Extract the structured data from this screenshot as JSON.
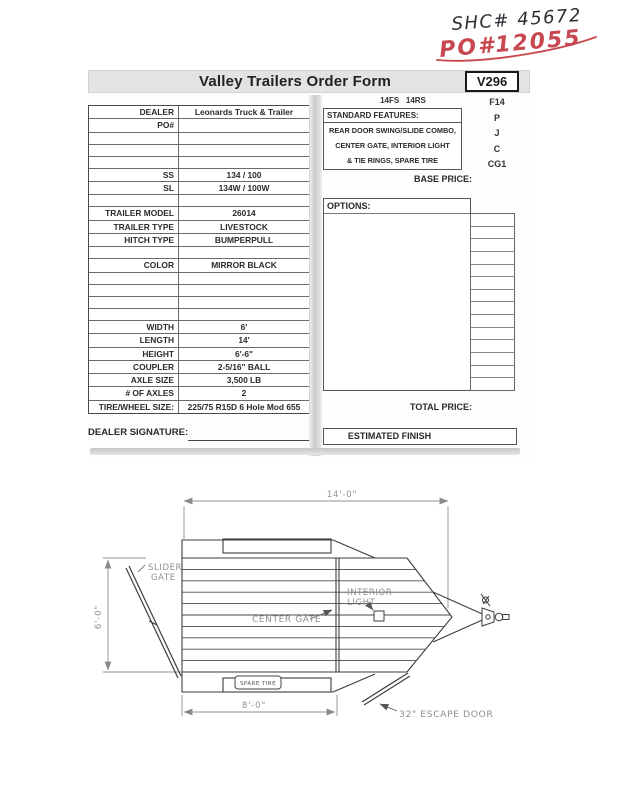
{
  "handwriting": {
    "line1": "SHC# 45672",
    "line2": "PO#12055"
  },
  "header": {
    "title": "Valley Trailers Order Form",
    "form_code": "V296",
    "model_codes": "14FS   14RS"
  },
  "feature_codes": [
    "F14",
    "P",
    "J",
    "C",
    "CG1"
  ],
  "standard_features": {
    "label": "STANDARD FEATURES:",
    "lines": [
      "REAR DOOR SWING/SLIDE COMBO,",
      "CENTER GATE, INTERIOR LIGHT",
      "& TIE RINGS, SPARE TIRE"
    ]
  },
  "spec_table": {
    "rows": [
      {
        "label": "DEALER",
        "value": "Leonards Truck & Trailer"
      },
      {
        "label": "PO#",
        "value": ""
      },
      {
        "label": "",
        "value": ""
      },
      {
        "label": "",
        "value": ""
      },
      {
        "label": "",
        "value": ""
      },
      {
        "label": "SS",
        "value": "134 / 100"
      },
      {
        "label": "SL",
        "value": "134W / 100W"
      },
      {
        "label": "",
        "value": ""
      },
      {
        "label": "TRAILER MODEL",
        "value": "26014"
      },
      {
        "label": "TRAILER TYPE",
        "value": "LIVESTOCK"
      },
      {
        "label": "HITCH TYPE",
        "value": "BUMPERPULL"
      },
      {
        "label": "",
        "value": ""
      },
      {
        "label": "COLOR",
        "value": "MIRROR BLACK"
      },
      {
        "label": "",
        "value": ""
      },
      {
        "label": "",
        "value": ""
      },
      {
        "label": "",
        "value": ""
      },
      {
        "label": "",
        "value": ""
      },
      {
        "label": "WIDTH",
        "value": "6'"
      },
      {
        "label": "LENGTH",
        "value": "14'"
      },
      {
        "label": "HEIGHT",
        "value": "6'-6\""
      },
      {
        "label": "COUPLER",
        "value": "2-5/16\" BALL"
      },
      {
        "label": "AXLE SIZE",
        "value": "3,500 LB"
      },
      {
        "label": "# OF AXLES",
        "value": "2"
      },
      {
        "label": "TIRE/WHEEL SIZE:",
        "value": "225/75 R15D 6 Hole Mod 655"
      }
    ]
  },
  "pricing": {
    "base_price_label": "BASE PRICE:",
    "options_label": "OPTIONS:",
    "total_price_label": "TOTAL PRICE:",
    "estimated_finish_label": "ESTIMATED FINISH",
    "option_cells": [
      "",
      "",
      "",
      "",
      "",
      "",
      "",
      "",
      "",
      "",
      "",
      "",
      "",
      ""
    ]
  },
  "signature": {
    "label": "DEALER SIGNATURE:"
  },
  "drawing": {
    "dim_overall_length": "14'-0\"",
    "dim_width": "6'-0\"",
    "dim_box_length": "8'-0\"",
    "labels": {
      "slider_gate_1": "SLIDER",
      "slider_gate_2": "GATE",
      "center_gate": "CENTER GATE",
      "interior_light_1": "INTERIOR",
      "interior_light_2": "LIGHT",
      "spare_tire": "SPARE TIRE",
      "escape_door": "32\" ESCAPE DOOR"
    }
  },
  "colors": {
    "handwriting_black": "#2e2e34",
    "handwriting_red": "#c84750",
    "titlebar_gray": "#e3e3e1"
  }
}
